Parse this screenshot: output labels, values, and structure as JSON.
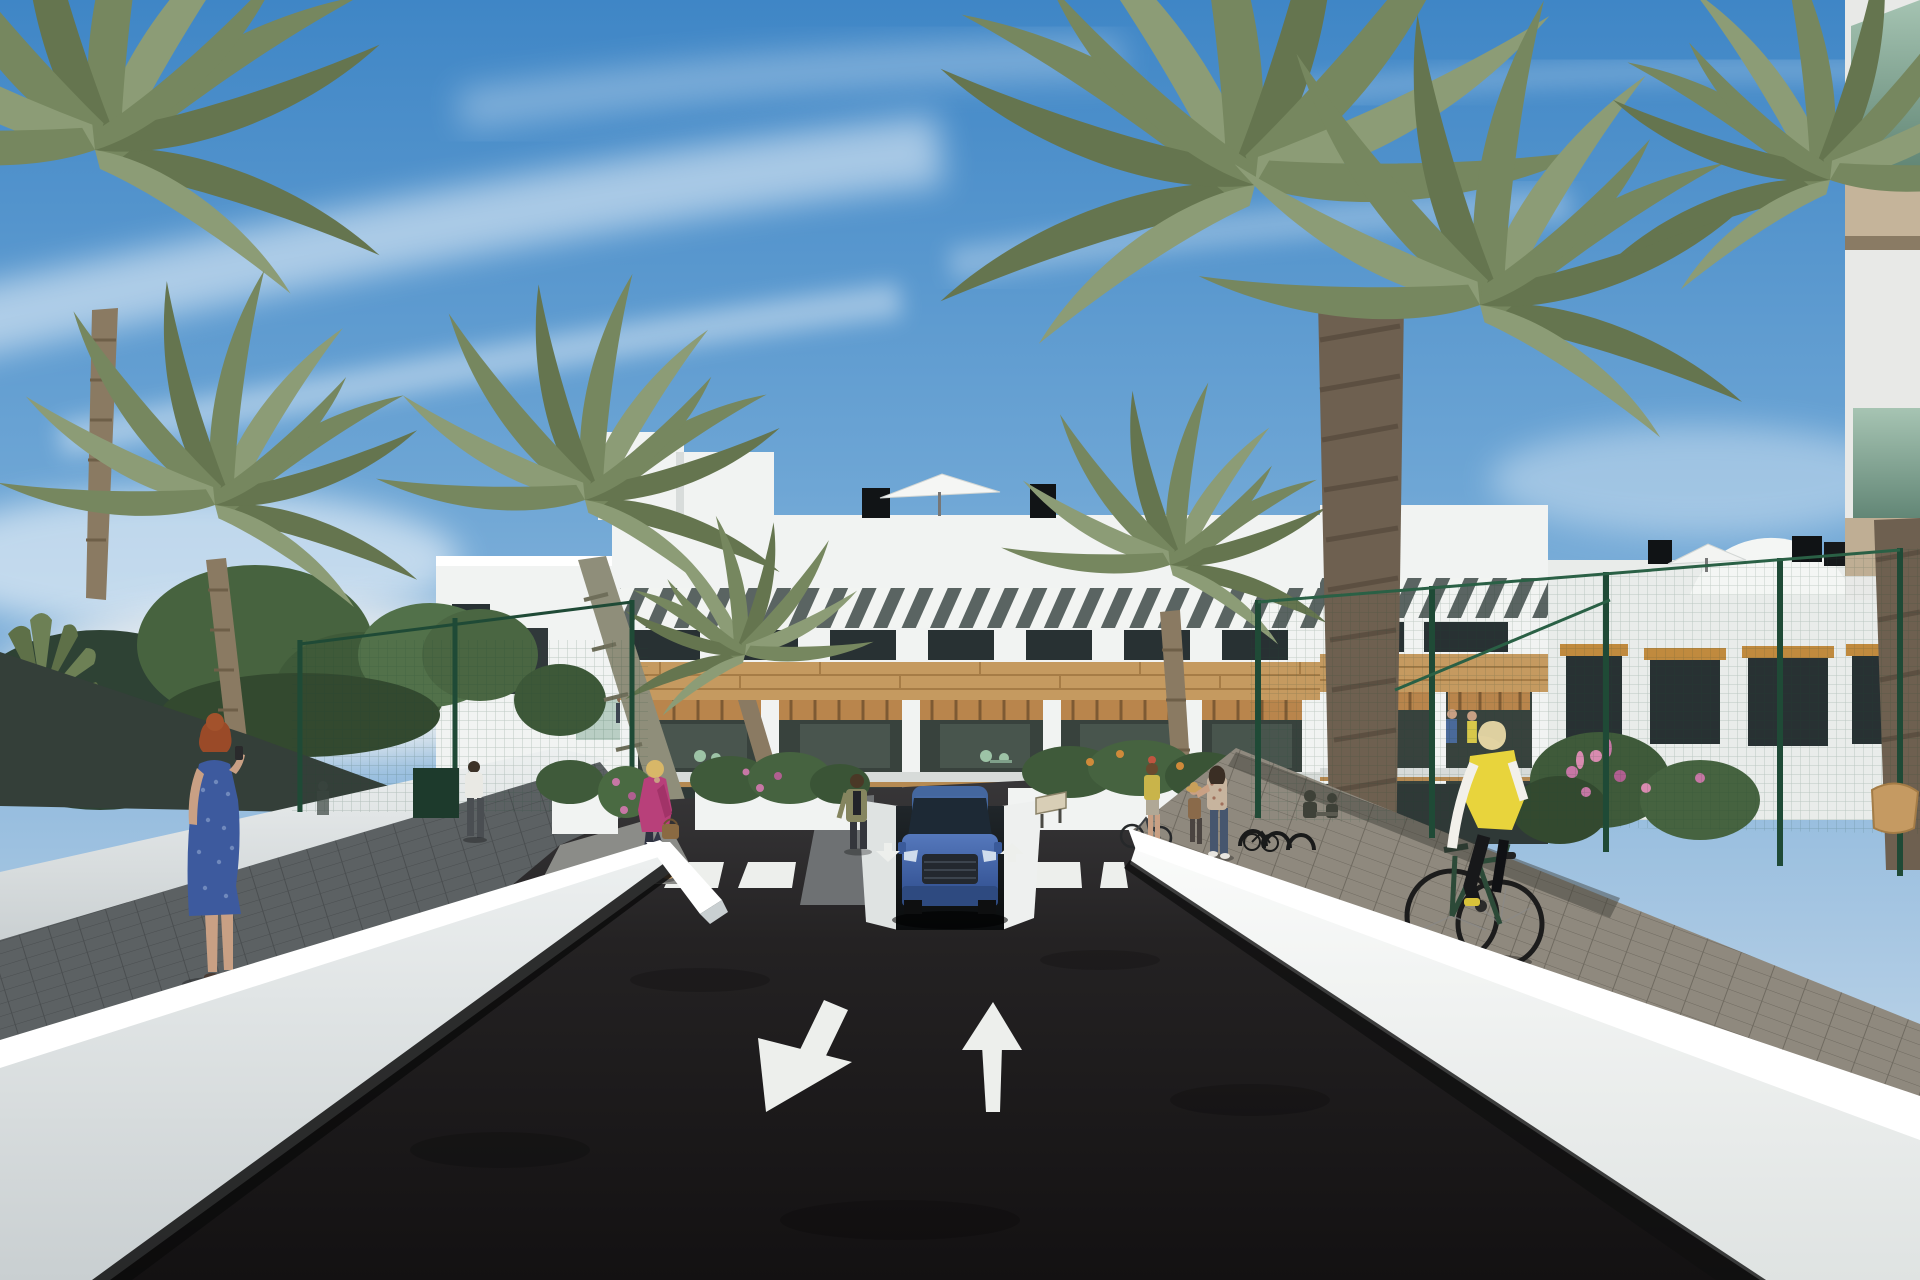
{
  "scene": {
    "type": "architectural-render",
    "setting": "new-build Mediterranean apartment complex seen from an access road",
    "time_of_day": "daytime",
    "weather": "sunny, blue sky with thin wispy clouds"
  },
  "palette": {
    "sky_top": "#3f86c6",
    "sky_mid": "#6ea6d5",
    "sky_horizon": "#d5e3ee",
    "cloud": "#ffffff",
    "asphalt_dark": "#151314",
    "asphalt_light": "#39383a",
    "marking_white": "#edefec",
    "wall_white": "#f1f3f2",
    "wall_cap": "#ffffff",
    "wall_shadow": "#c7cdcf",
    "sidewalk_shadow": "#5c6163",
    "paver_sunlit": "#8f897e",
    "building_white": "#f4f6f4",
    "slat_dark": "#5a6462",
    "wood_band": "#c59a60",
    "pergola_wood": "#b9854c",
    "window_dark": "#283133",
    "terrace_dark": "#38423d",
    "glass_green": "#7fa892",
    "palm_frond": "#76875f",
    "palm_frond_dark": "#65754f",
    "palm_frond_light": "#8c9c76",
    "palm_trunk": "#8a7a62",
    "palm_trunk_fiber": "#6e6050",
    "tree_green": "#47633f",
    "fence_green": "#1f4a36",
    "sail_dark": "#343f39",
    "hedge_green": "#3f5a3a",
    "flower_pink": "#c777a5",
    "flower_orange": "#cf8a3a",
    "car_blue": "#3f63aa",
    "car_glass": "#1d2935",
    "skin": "#c9a084"
  },
  "road": {
    "surface": "dark asphalt",
    "crosswalk_stripe_count": 6,
    "lane_arrows": [
      {
        "direction": "toward viewer (down-left)"
      },
      {
        "direction": "away from viewer (up)"
      }
    ],
    "ramp_arrows": [
      {
        "direction": "down"
      },
      {
        "direction": "up"
      }
    ],
    "garage": "underground parking ramp below central building"
  },
  "vehicles": {
    "car": {
      "type": "SUV",
      "color": "blue",
      "position": "exiting garage ramp, front view"
    },
    "bicycles": "one ridden by cyclist, one standing, two parked at racks"
  },
  "people": [
    {
      "id": "woman-blue-dress",
      "where": "left sidewalk",
      "look": "red hair, blue patterned dress, phone to ear, back view"
    },
    {
      "id": "woman-pink-jacket",
      "where": "left path near crosswalk",
      "look": "blonde, magenta jacket, dark jeans, brown handbag"
    },
    {
      "id": "person-white-shirt",
      "where": "left walkway by fence",
      "look": "white t-shirt, dark trousers, back view"
    },
    {
      "id": "woman-olive-jacket",
      "where": "centre path beside garage",
      "look": "olive jacket, dark top and trousers"
    },
    {
      "id": "woman-yellow-top",
      "where": "right sidewalk",
      "look": "standing with bicycle"
    },
    {
      "id": "child-with-hat",
      "where": "right sidewalk",
      "look": "small child wearing sun hat"
    },
    {
      "id": "woman-floral-top",
      "where": "right sidewalk",
      "look": "reaching toward child"
    },
    {
      "id": "cyclist",
      "where": "right sidewalk foreground",
      "look": "blonde, yellow vest, white sleeves, black trousers, dark bicycle"
    },
    {
      "id": "terrace-couple",
      "where": "right wing first-floor terrace",
      "look": "two small figures"
    }
  ],
  "buildings": {
    "main_block": "white 3-storey apartments, diagonal white roof slats, timber cladding band, deep terraces with wooden pergolas",
    "rooftop": "white parasols, black chimneys, curved white volume",
    "right_foreground": "corner of building with green glass balconies and timber soffits"
  },
  "vegetation": {
    "palm_count": 8,
    "other": "fan palm, leafy trees, hedges, pink and orange flowering shrubs"
  },
  "street_furniture": {
    "fences": "green mesh fencing both sides",
    "shade_sail": "dark shade sail over left garden",
    "bike_racks": "black hoop racks on right sidewalk",
    "sign": "small beige plate beside garage exit"
  }
}
